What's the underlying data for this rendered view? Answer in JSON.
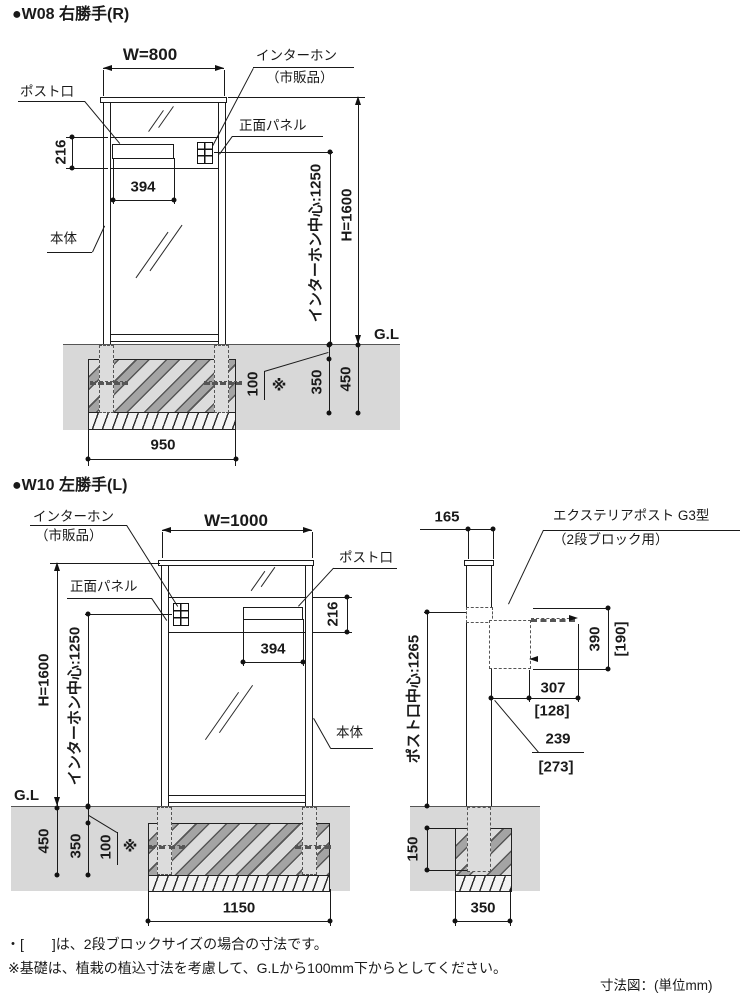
{
  "w08": {
    "title": "●W08 右勝手(R)",
    "labels": {
      "post_slot": "ポスト口",
      "interphone": "インターホン",
      "interphone_note": "（市販品）",
      "front_panel": "正面パネル",
      "body": "本体",
      "ground_line": "G.L",
      "interphone_center": "インターホン中心:1250",
      "height": "H=1600"
    },
    "dims": {
      "width": "W=800",
      "slot_band_height": "216",
      "slot_width": "394",
      "embed_top": "100",
      "embed_note": "※",
      "footing_height": "350",
      "footing_total": "450",
      "footing_width": "950"
    }
  },
  "w10": {
    "title": "●W10 左勝手(L)",
    "labels": {
      "post_slot": "ポスト口",
      "interphone": "インターホン",
      "interphone_note": "（市販品）",
      "front_panel": "正面パネル",
      "body": "本体",
      "ground_line": "G.L",
      "interphone_center": "インターホン中心:1250",
      "height": "H=1600"
    },
    "dims": {
      "width": "W=1000",
      "slot_band_height": "216",
      "slot_width": "394",
      "embed_top": "100",
      "embed_note": "※",
      "footing_height": "350",
      "footing_total": "450",
      "footing_width": "1150"
    }
  },
  "side": {
    "labels": {
      "product_line1": "エクステリアポスト G3型",
      "product_line2": "（2段ブロック用）",
      "slot_center": "ポスト口中心:1265"
    },
    "dims": {
      "post_depth": "165",
      "box_height": "390",
      "box_height_alt": "[190]",
      "box_top_depth": "307",
      "box_top_depth_alt": "[128]",
      "box_front_offset": "239",
      "box_front_offset_alt": "[273]",
      "post_embed": "150",
      "footing_width": "350"
    }
  },
  "notes": {
    "bracket_note": "・[　　]は、2段ブロックサイズの場合の寸法です。",
    "foundation_note": "※基礎は、植栽の植込寸法を考慮して、G.Lから100mm下からとしてください。",
    "caption": "寸法図：(単位mm)"
  }
}
